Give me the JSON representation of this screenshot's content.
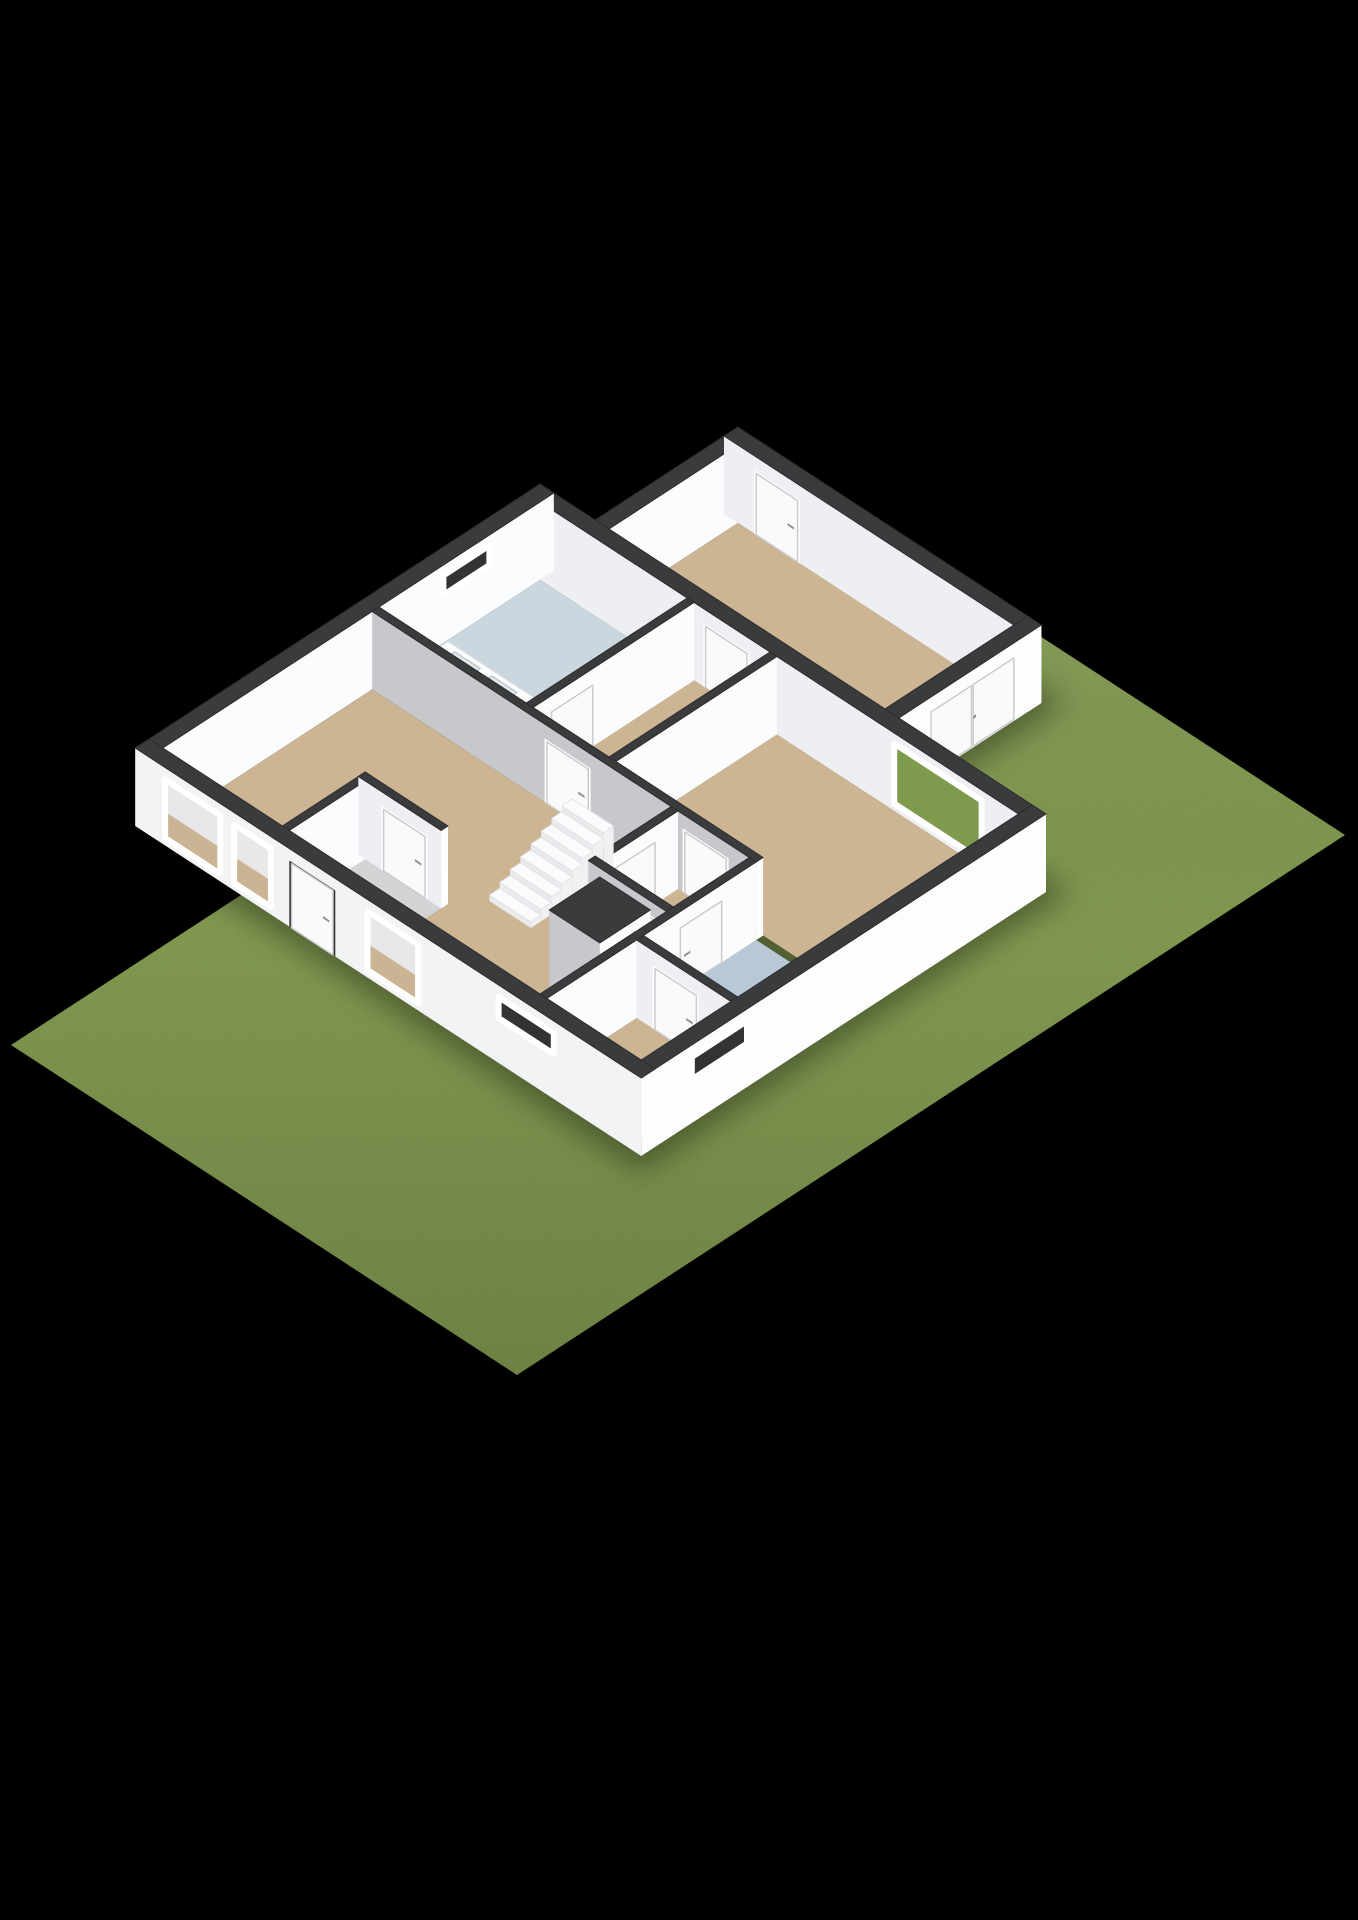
{
  "scene": {
    "kind": "isometric-3d-floorplan-cutaway-render",
    "background": "#000000",
    "ground": "grass-lot"
  },
  "colors": {
    "background": "#000000",
    "grass": "#7C944A",
    "grassShade": "#6E873F",
    "grassThroughWindow": "#7E9A4C",
    "wallTop": "#3A3B3D",
    "wallTopEdge": "#2B2C2E",
    "wallOuterSW": "#F2F3F5",
    "wallOuterSE": "#FDFDFE",
    "wallInnerLight": "#EDEFF2",
    "wallInnerGray": "#C6C8CB",
    "wallInnerEast": "#FBFCFD",
    "jamb": "#FFFFFF",
    "floorBeige": "#CDB493",
    "bathroomBlue": "#B9C8D7",
    "showerBlue": "#CBD7DF",
    "woodFloor": "#B1895C",
    "tileGray": "#D3D4D6",
    "doorLeaf": "#FAFAFB",
    "doorStroke": "#C9CBCE",
    "doorHandle": "#8E9398",
    "windowFrame": "#FFFFFF",
    "windowVoid": "#313335",
    "windowInteriorUpper": "#E8E8EA",
    "windowInteriorLower": "#CBB493",
    "stepTop": "#FAFBFC",
    "stepRiser": "#E8EAEC",
    "stepSide": "#F0F1F3",
    "vanityBasin": "#E3E8EA",
    "vanityBasinStroke": "#C2C8CC"
  },
  "rooms": [
    {
      "id": "living-room",
      "floor": "beige"
    },
    {
      "id": "entrance-vestibule",
      "floor": "gray-tile"
    },
    {
      "id": "rear-hall",
      "floor": "beige"
    },
    {
      "id": "kitchen-bathroom",
      "floor": "shower-blue-and-wood"
    },
    {
      "id": "bedroom",
      "floor": "beige"
    },
    {
      "id": "inner-hall",
      "floor": "beige"
    },
    {
      "id": "bathroom",
      "floor": "light-blue"
    },
    {
      "id": "corner-room",
      "floor": "beige"
    },
    {
      "id": "extension-room",
      "floor": "beige"
    }
  ],
  "features": [
    "staircase-8-steps",
    "vanity-with-two-basins",
    "freestanding-chimney-block",
    "front-door",
    "interior-doors-with-handles",
    "garden-double-door-extension",
    "bedroom-window-grass-view",
    "three-front-windows",
    "high-small-front-window",
    "side-wall-small-window",
    "slot-window-rear-wall"
  ]
}
